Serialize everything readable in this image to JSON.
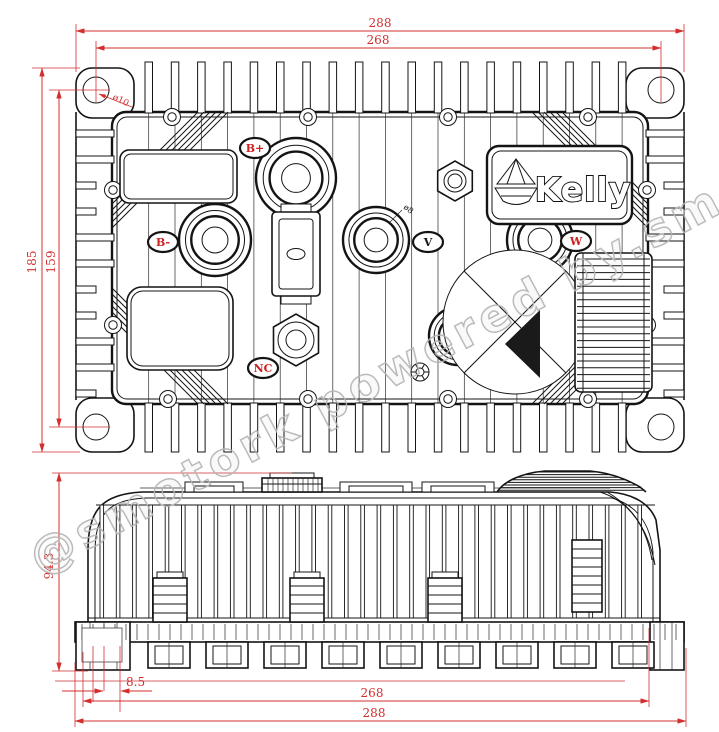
{
  "drawing": {
    "brand": {
      "logo_text": "Kelly"
    },
    "watermark": "@smotork powered by.sm",
    "top_view": {
      "dim_width_overall": "288",
      "dim_width_hole_centers": "268",
      "dim_height_overall": "185",
      "dim_height_hole_centers": "159",
      "dim_corner_hole_diameter": "ø10",
      "dim_stud_diameter": "ø8",
      "terminal_labels": [
        {
          "id": "b-plus",
          "label": "B+",
          "color": "red"
        },
        {
          "id": "b-minus",
          "label": "B-",
          "color": "red"
        },
        {
          "id": "phase-v",
          "label": "V",
          "color": "black"
        },
        {
          "id": "phase-w",
          "label": "W",
          "color": "red"
        },
        {
          "id": "nc",
          "label": "NC",
          "color": "red"
        }
      ]
    },
    "side_view": {
      "dim_height_overall": "94.3",
      "dim_foot_offset": "8.5",
      "dim_width_hole_centers": "268",
      "dim_width_overall": "288"
    },
    "colors": {
      "line": "#141414",
      "dim": "#d32f2f",
      "wm": "#b4b4b4",
      "label_red": "#cc2020"
    }
  }
}
